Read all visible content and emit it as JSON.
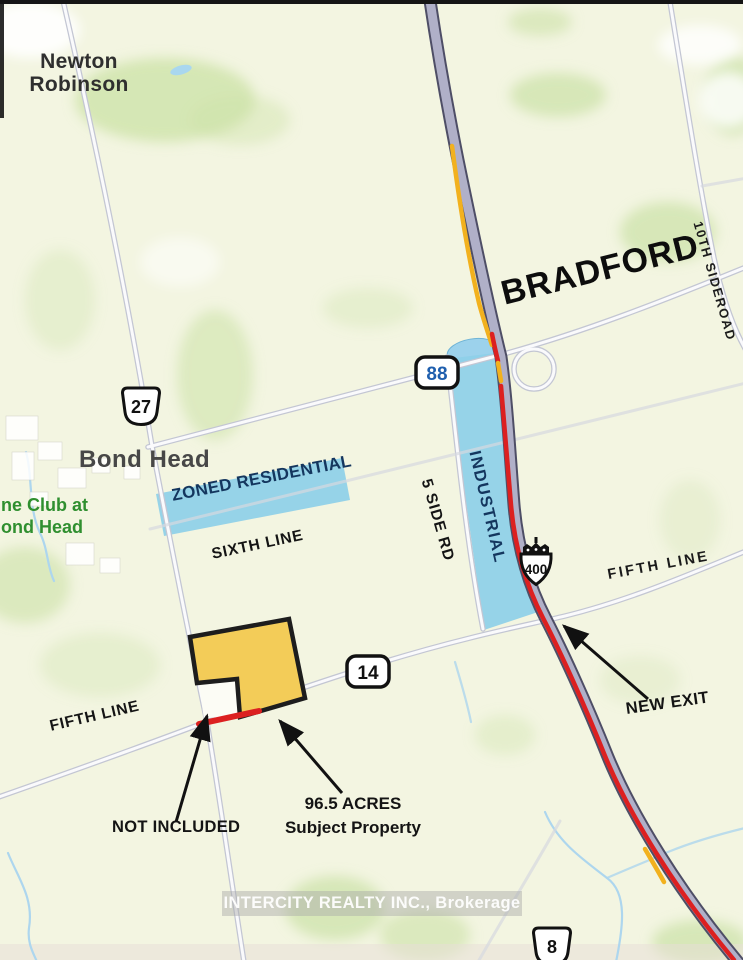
{
  "map": {
    "places": {
      "newton_line1": "Newton",
      "newton_line2": "Robinson",
      "bradford": "BRADFORD",
      "bond_head": "Bond Head",
      "club_line1": "ne Club at",
      "club_line2": "ond Head"
    },
    "roads": {
      "tenth_sideroad": "10TH SIDEROAD",
      "five_side_rd": "5 SIDE RD",
      "sixth_line": "SIXTH LINE",
      "fifth_line_west": "FIFTH LINE",
      "fifth_line_east": "FIFTH LINE"
    },
    "zones": {
      "residential": "ZONED RESIDENTIAL",
      "industrial": "INDUSTRIAL"
    },
    "annotations": {
      "new_exit": "NEW EXIT",
      "not_included": "NOT INCLUDED",
      "acreage": "96.5 ACRES",
      "subject": "Subject Property"
    },
    "shields": {
      "hwy27": "27",
      "hwy88": "88",
      "hwy400": "400",
      "hwy14": "14",
      "hwy8": "8"
    },
    "watermark": "INTERCITY REALTY INC., Brokerage",
    "colors": {
      "subject_parcel_yellow": "#f3cc58",
      "zoning_blue": "#8ecfe8",
      "zoning_text_navy": "#14365e",
      "highway_red": "#dc2020",
      "highway_yellow": "#f2b11e",
      "freeway_gray": "#b0b0c8",
      "club_green": "#2f8f2f"
    }
  }
}
